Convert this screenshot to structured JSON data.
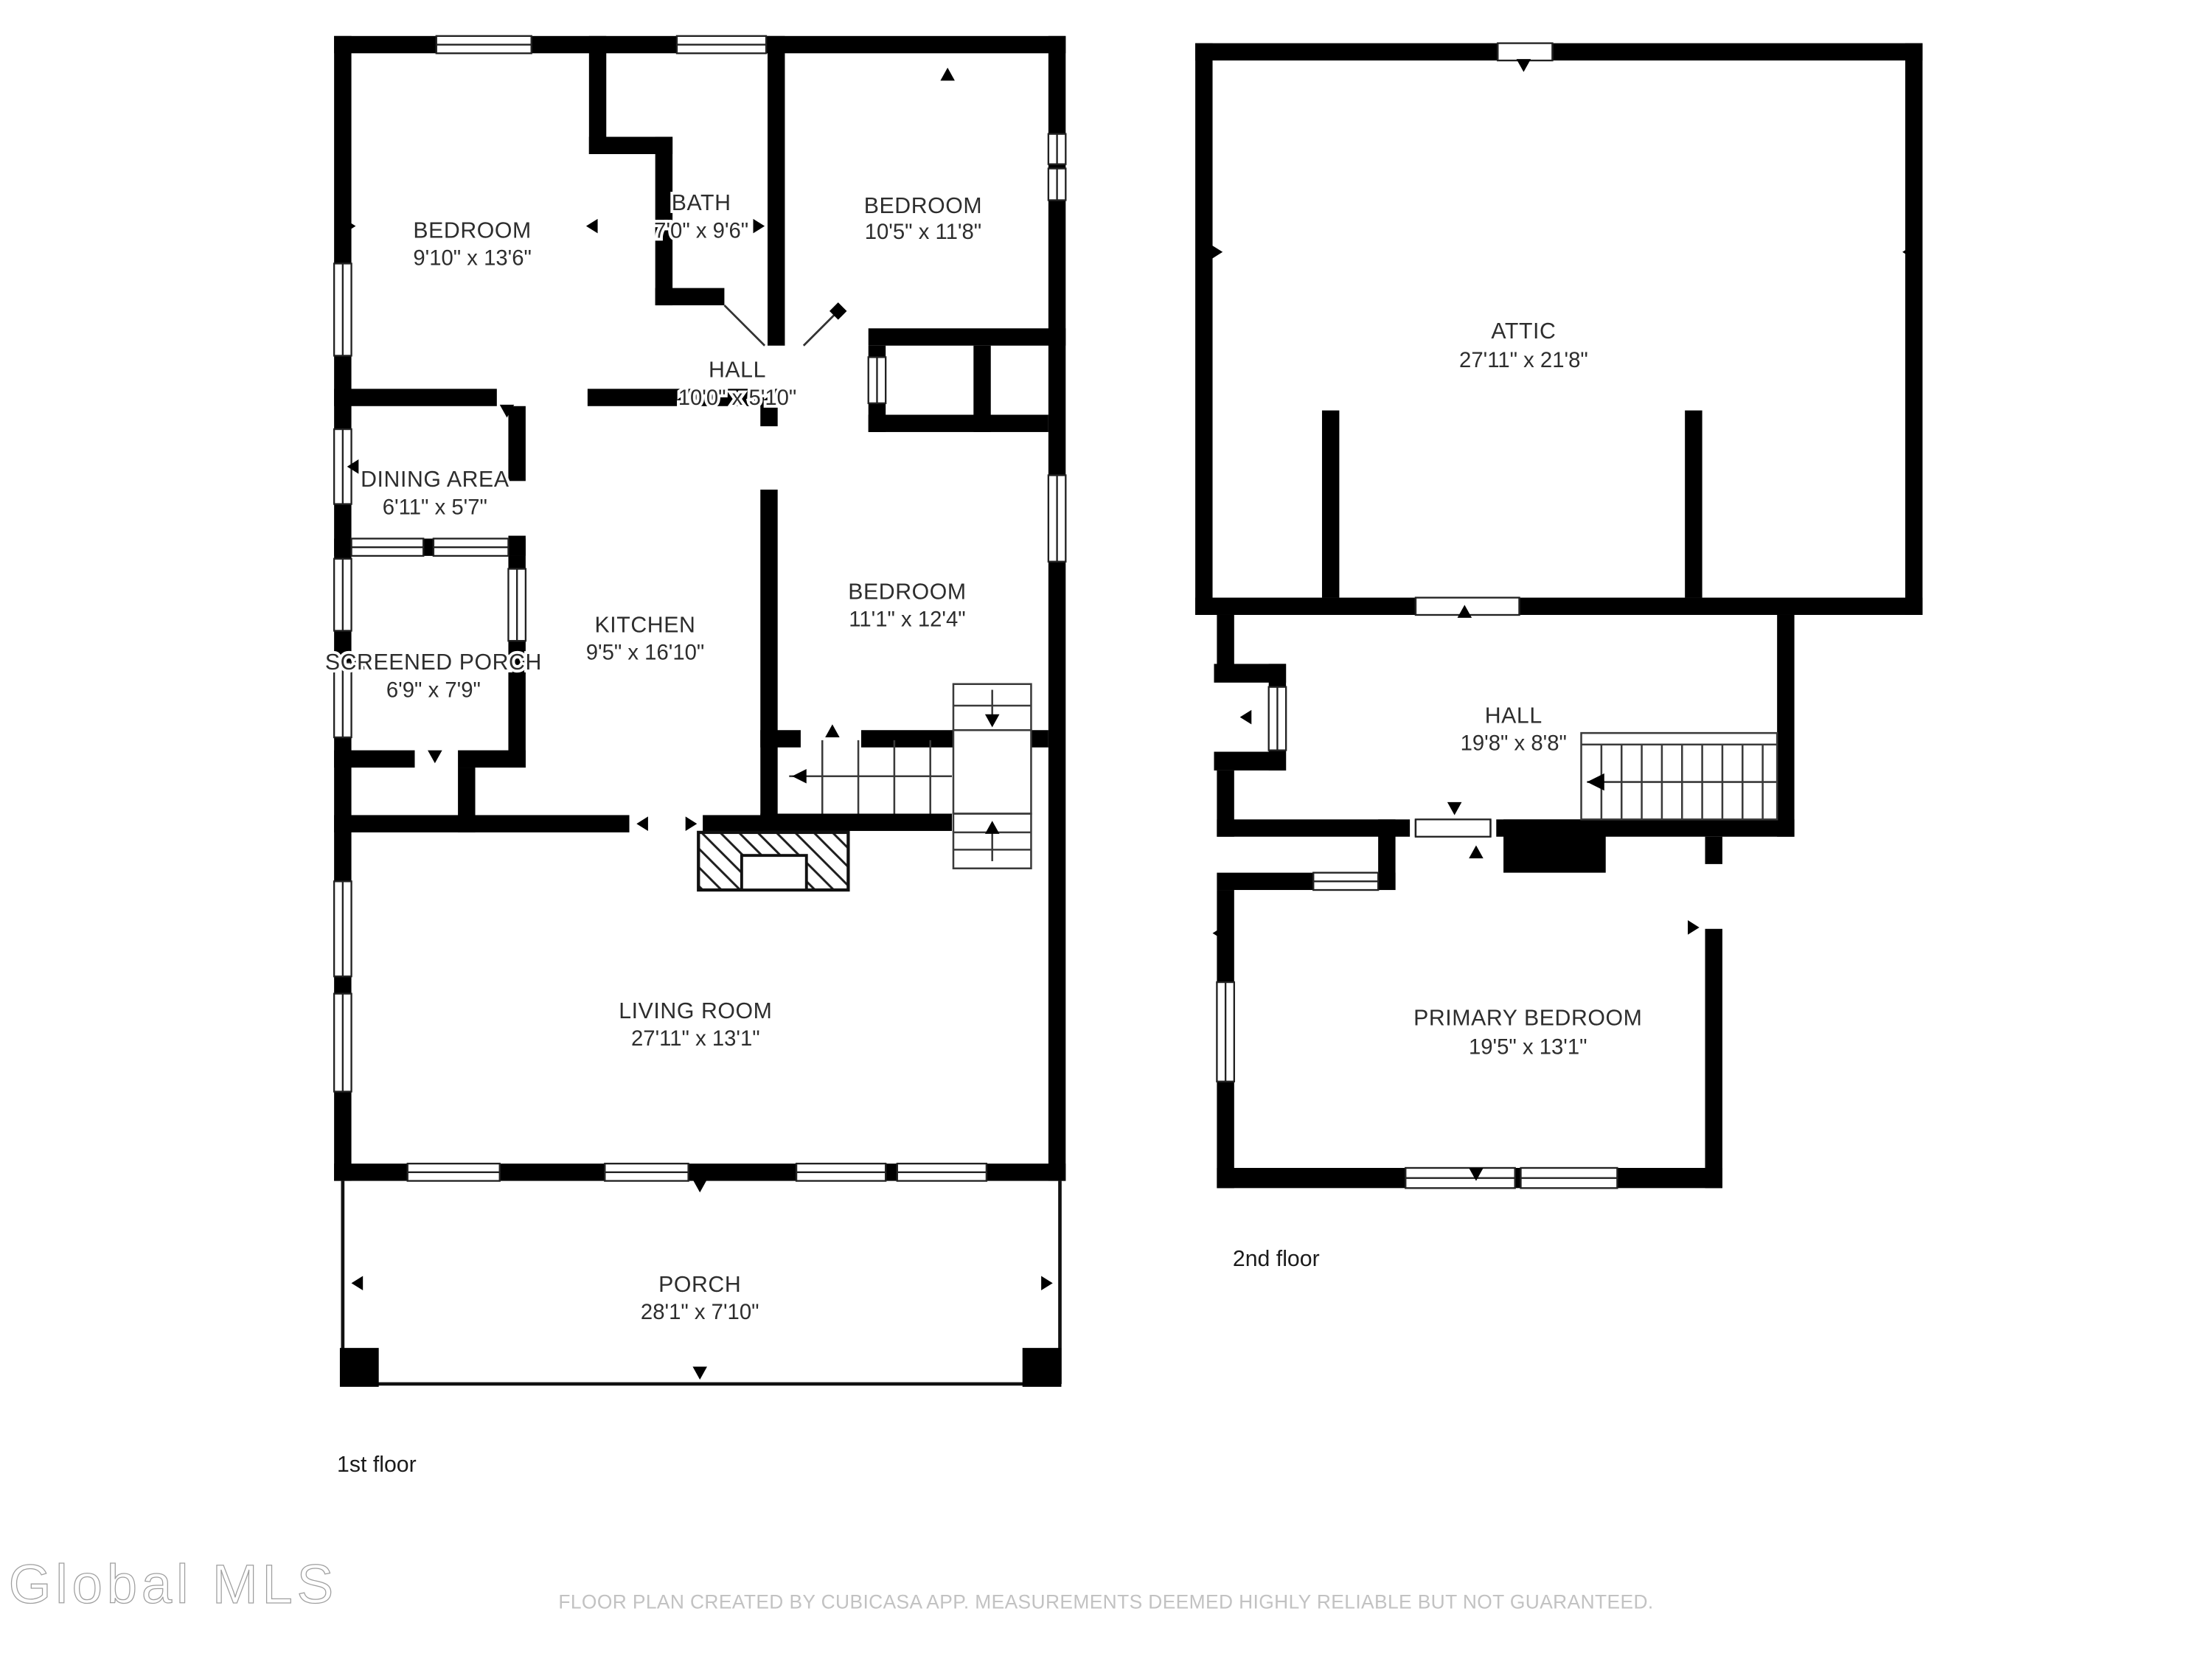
{
  "document": {
    "type": "floor-plan",
    "background": "#ffffff"
  },
  "colors": {
    "wall": "#000000",
    "label_text": "#2d2d2d",
    "muted_text": "#c2c2c2",
    "logo_gray": "#9f9f9f"
  },
  "floor1": {
    "label": "1st floor",
    "rooms": {
      "bedroom_tl": {
        "name": "BEDROOM",
        "dims": "9'10\" x 13'6\""
      },
      "bath": {
        "name": "BATH",
        "dims": "7'0\" x 9'6\""
      },
      "bedroom_tr": {
        "name": "BEDROOM",
        "dims": "10'5\" x 11'8\""
      },
      "hall": {
        "name": "HALL",
        "dims": "10'0\" x 5'10\""
      },
      "dining": {
        "name": "DINING AREA",
        "dims": "6'11\" x 5'7\""
      },
      "screened_porch": {
        "name": "SCREENED PORCH",
        "dims": "6'9\" x 7'9\""
      },
      "kitchen": {
        "name": "KITCHEN",
        "dims": "9'5\" x 16'10\""
      },
      "bedroom_mid": {
        "name": "BEDROOM",
        "dims": "11'1\" x 12'4\""
      },
      "living": {
        "name": "LIVING ROOM",
        "dims": "27'11\" x 13'1\""
      },
      "porch": {
        "name": "PORCH",
        "dims": "28'1\" x 7'10\""
      }
    }
  },
  "floor2": {
    "label": "2nd floor",
    "rooms": {
      "attic": {
        "name": "ATTIC",
        "dims": "27'11\" x 21'8\""
      },
      "hall": {
        "name": "HALL",
        "dims": "19'8\" x 8'8\""
      },
      "primary_bedroom": {
        "name": "PRIMARY BEDROOM",
        "dims": "19'5\" x 13'1\""
      }
    }
  },
  "footer": {
    "logo": "Global MLS",
    "disclaimer": "FLOOR PLAN CREATED BY CUBICASA APP. MEASUREMENTS DEEMED HIGHLY RELIABLE BUT NOT GUARANTEED."
  }
}
